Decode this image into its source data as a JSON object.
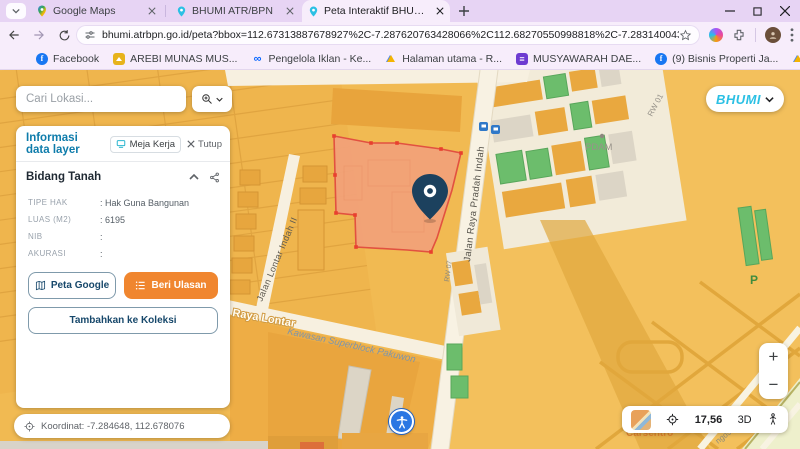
{
  "browser": {
    "tabs": [
      {
        "label": "Google Maps"
      },
      {
        "label": "BHUMI ATR/BPN"
      },
      {
        "label": "Peta Interaktif BHUMI ATR/BPN"
      }
    ],
    "url": "bhumi.atrbpn.go.id/peta?bbox=112.67313887678927%2C-7.287620763428066%2C112.68270550998818%2C-7.283140043732985&height=645&width=1366...",
    "bookmarks": {
      "items": [
        {
          "label": "Facebook"
        },
        {
          "label": "AREBI MUNAS MUS..."
        },
        {
          "label": "Pengelola Iklan - Ke..."
        },
        {
          "label": "Halaman utama - R..."
        },
        {
          "label": "MUSYAWARAH DAE..."
        },
        {
          "label": "(9) Bisnis Properti Ja..."
        },
        {
          "label": "Halaman utama - R..."
        }
      ],
      "all_label": "Semua Bookmark"
    }
  },
  "search": {
    "placeholder": "Cari Lokasi..."
  },
  "panel": {
    "title": "Informasi data layer",
    "meja_kerja": "Meja Kerja",
    "tutup": "Tutup",
    "section_title": "Bidang Tanah",
    "fields": [
      {
        "label": "TIPE HAK",
        "value": ": Hak Guna Bangunan"
      },
      {
        "label": "LUAS (M2)",
        "value": ": 6195"
      },
      {
        "label": "NIB",
        "value": ":"
      },
      {
        "label": "AKURASI",
        "value": ":"
      }
    ],
    "buttons": {
      "peta_google": "Peta Google",
      "beri_ulasan": "Beri Ulasan",
      "tambah_koleksi": "Tambahkan ke Koleksi"
    },
    "koordinat": "Koordinat: -7.284648, 112.678076"
  },
  "logo": {
    "text": "BHUMI"
  },
  "map": {
    "labels": {
      "jalan_lontar": "Jalan Lontar Indah II",
      "jalan_raya": "Jalan Raya Pradah Indah",
      "raya_lontar": "Raya Lontar",
      "kawasan": "Kawasan Superblock Pakuwon",
      "rw01": "RW 01",
      "rw07": "RW 07",
      "pdam": "PDAM",
      "parking": "P",
      "carsentro": "Carsentro",
      "ngose": "ngose,"
    },
    "colors": {
      "base": "#f1ba52",
      "parcel_fill": "#f1a178",
      "parcel_stroke": "#e25140",
      "pin": "#1c415e",
      "green_building": "#6cbd6c"
    }
  },
  "controls": {
    "zoom_in": "+",
    "zoom_out": "−",
    "scale": "17,56",
    "three_d": "3D"
  }
}
